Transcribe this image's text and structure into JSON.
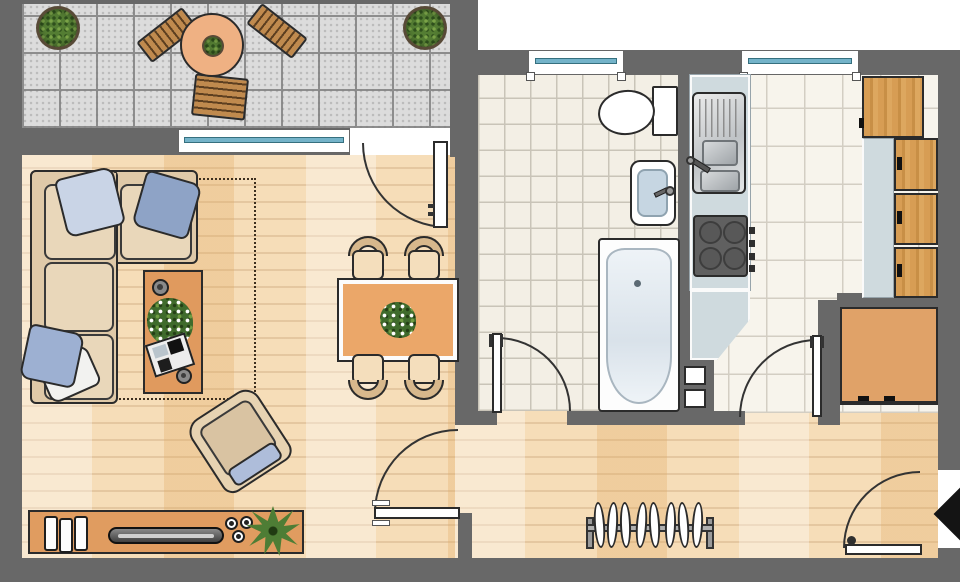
{
  "plan": {
    "title": "Apartment floor plan",
    "canvas": {
      "width": 960,
      "height": 582
    }
  },
  "palette": {
    "wall": "#686868",
    "wood_floor": "#f6ddb8",
    "balcony_tile": "#dcdcdc",
    "bath_tile": "#f3efe5",
    "kitchen_tile": "#f7f4ec",
    "furniture_wood": "#e09a5e",
    "cabinet_oak": "#d79d54",
    "counter": "#cfdade",
    "upholstery": "#dfc9a8",
    "pillow_blue": "#8ea3c6",
    "window_glass": "#74b3c9",
    "plant_green": "#547d33",
    "appliance_gray": "#606060",
    "entrance_marker": "#141414"
  },
  "rooms": {
    "balcony": {
      "name": "Balcony",
      "floor": "concrete tiles",
      "items": [
        "potted plant",
        "potted plant",
        "round garden table with plant",
        "deck chair",
        "deck chair",
        "deck chair"
      ]
    },
    "living_room": {
      "name": "Living room",
      "floor": "parquet",
      "items": [
        "corner sofa with four pillows",
        "rug area (dashed outline)",
        "coffee table with cup, flower bouquet, magazines, cup",
        "armchair with blue cushion",
        "lowboard with books, flat TV, three tea lights, plant",
        "dining table with flower centerpiece",
        "four dining chairs"
      ]
    },
    "bathroom": {
      "name": "Bathroom",
      "floor": "ceramic tiles",
      "items": [
        "toilet with cistern",
        "washbasin with faucet",
        "bathtub"
      ]
    },
    "kitchen": {
      "name": "Kitchen",
      "floor": "ceramic tiles",
      "items": [
        "worktop",
        "sink unit with drainer",
        "stove with four burners and knobs",
        "angled worktop end",
        "tall cabinet",
        "three wall cabinets with handles",
        "side counter",
        "cabinet in niche with two drawers",
        "service shaft"
      ]
    },
    "hallway": {
      "name": "Hallway",
      "floor": "parquet",
      "items": [
        "coat rack with eight hangers"
      ]
    }
  },
  "openings": {
    "windows": [
      {
        "name": "living room window"
      },
      {
        "name": "bathroom window"
      },
      {
        "name": "kitchen window"
      }
    ],
    "doors": [
      {
        "name": "balcony door"
      },
      {
        "name": "living room door"
      },
      {
        "name": "bathroom door"
      },
      {
        "name": "kitchen door"
      },
      {
        "name": "entrance door"
      }
    ],
    "entrance_marker": {
      "name": "entrance arrow",
      "shape": "black diamond"
    }
  }
}
